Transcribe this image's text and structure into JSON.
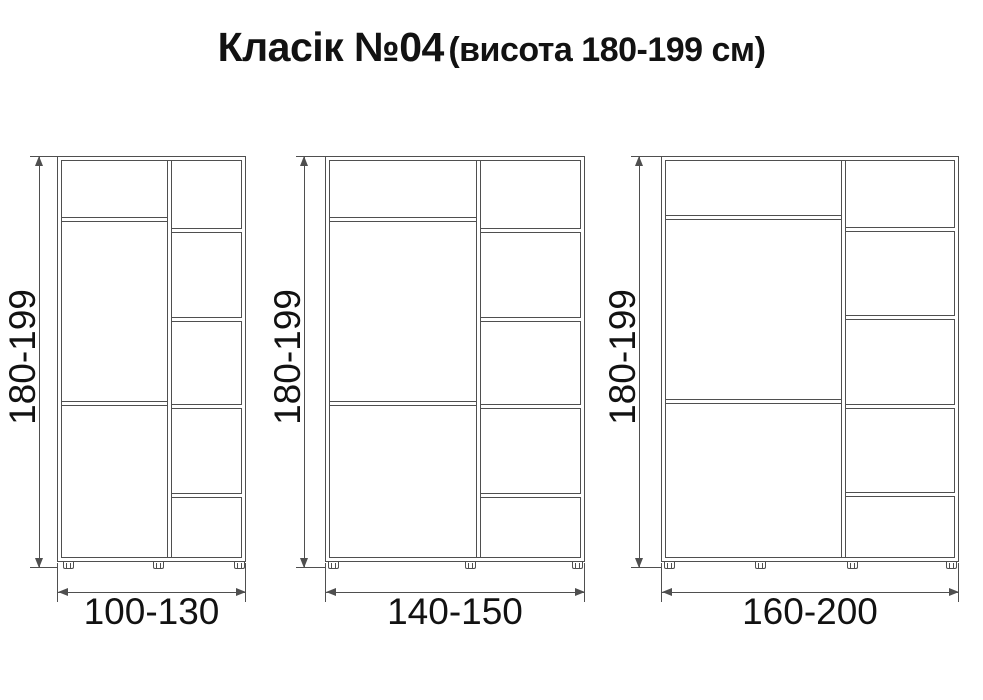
{
  "title": {
    "main": "Класік №04",
    "sub": "(висота 180-199 см)"
  },
  "colors": {
    "line": "#4f4f4f",
    "text": "#121212",
    "background": "#ffffff"
  },
  "cabinets": [
    {
      "id": "wardrobe-100-130",
      "height_label": "180-199",
      "width_label": "100-130"
    },
    {
      "id": "wardrobe-140-150",
      "height_label": "180-199",
      "width_label": "140-150"
    },
    {
      "id": "wardrobe-160-200",
      "height_label": "180-199",
      "width_label": "160-200"
    }
  ]
}
